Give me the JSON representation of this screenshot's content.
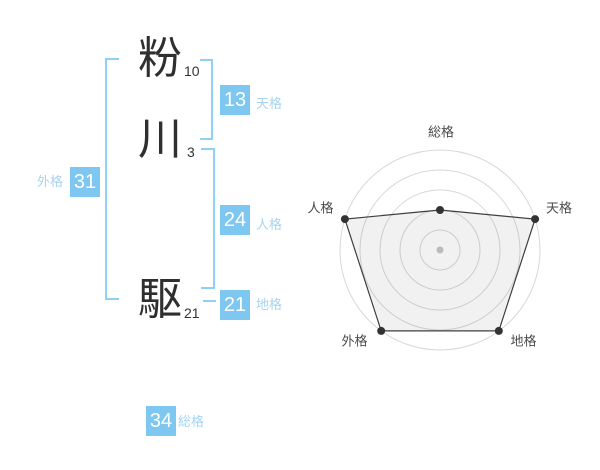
{
  "name": {
    "surname": [
      {
        "char": "粉",
        "strokes": "10"
      },
      {
        "char": "川",
        "strokes": "3"
      }
    ],
    "given": [
      {
        "char": "駆",
        "strokes": "21"
      }
    ]
  },
  "kaku": {
    "tenkaku": {
      "label": "天格",
      "value": "13"
    },
    "jinkaku": {
      "label": "人格",
      "value": "24"
    },
    "chikaku": {
      "label": "地格",
      "value": "21"
    },
    "gaikaku": {
      "label": "外格",
      "value": "31"
    },
    "soukaku": {
      "label": "総格",
      "value": "34"
    }
  },
  "colors": {
    "value_box_blue": "#7ec7f1",
    "kaku_label_blue": "#a6d4f1",
    "bracket_blue": "#8ed1f5",
    "ink_dark": "#2f2f2f",
    "radar_ring_gray": "#d8d8d8",
    "radar_line_dark": "#3f3f3f",
    "radar_center_dot_gray": "#bbbbbb"
  },
  "chart_data": {
    "type": "radar",
    "title": "",
    "axes": [
      "総格",
      "天格",
      "地格",
      "外格",
      "人格"
    ],
    "series": [
      {
        "name": "name-fortune-plot",
        "values_pct": [
          40,
          100,
          100,
          100,
          100
        ]
      }
    ],
    "axis_values": {
      "総格": 34,
      "天格": 13,
      "地格": 21,
      "外格": 31,
      "人格": 24
    },
    "rings": 5,
    "max_pct": 100,
    "center_dot": true,
    "legend": false,
    "grid": "concentric-circles"
  }
}
